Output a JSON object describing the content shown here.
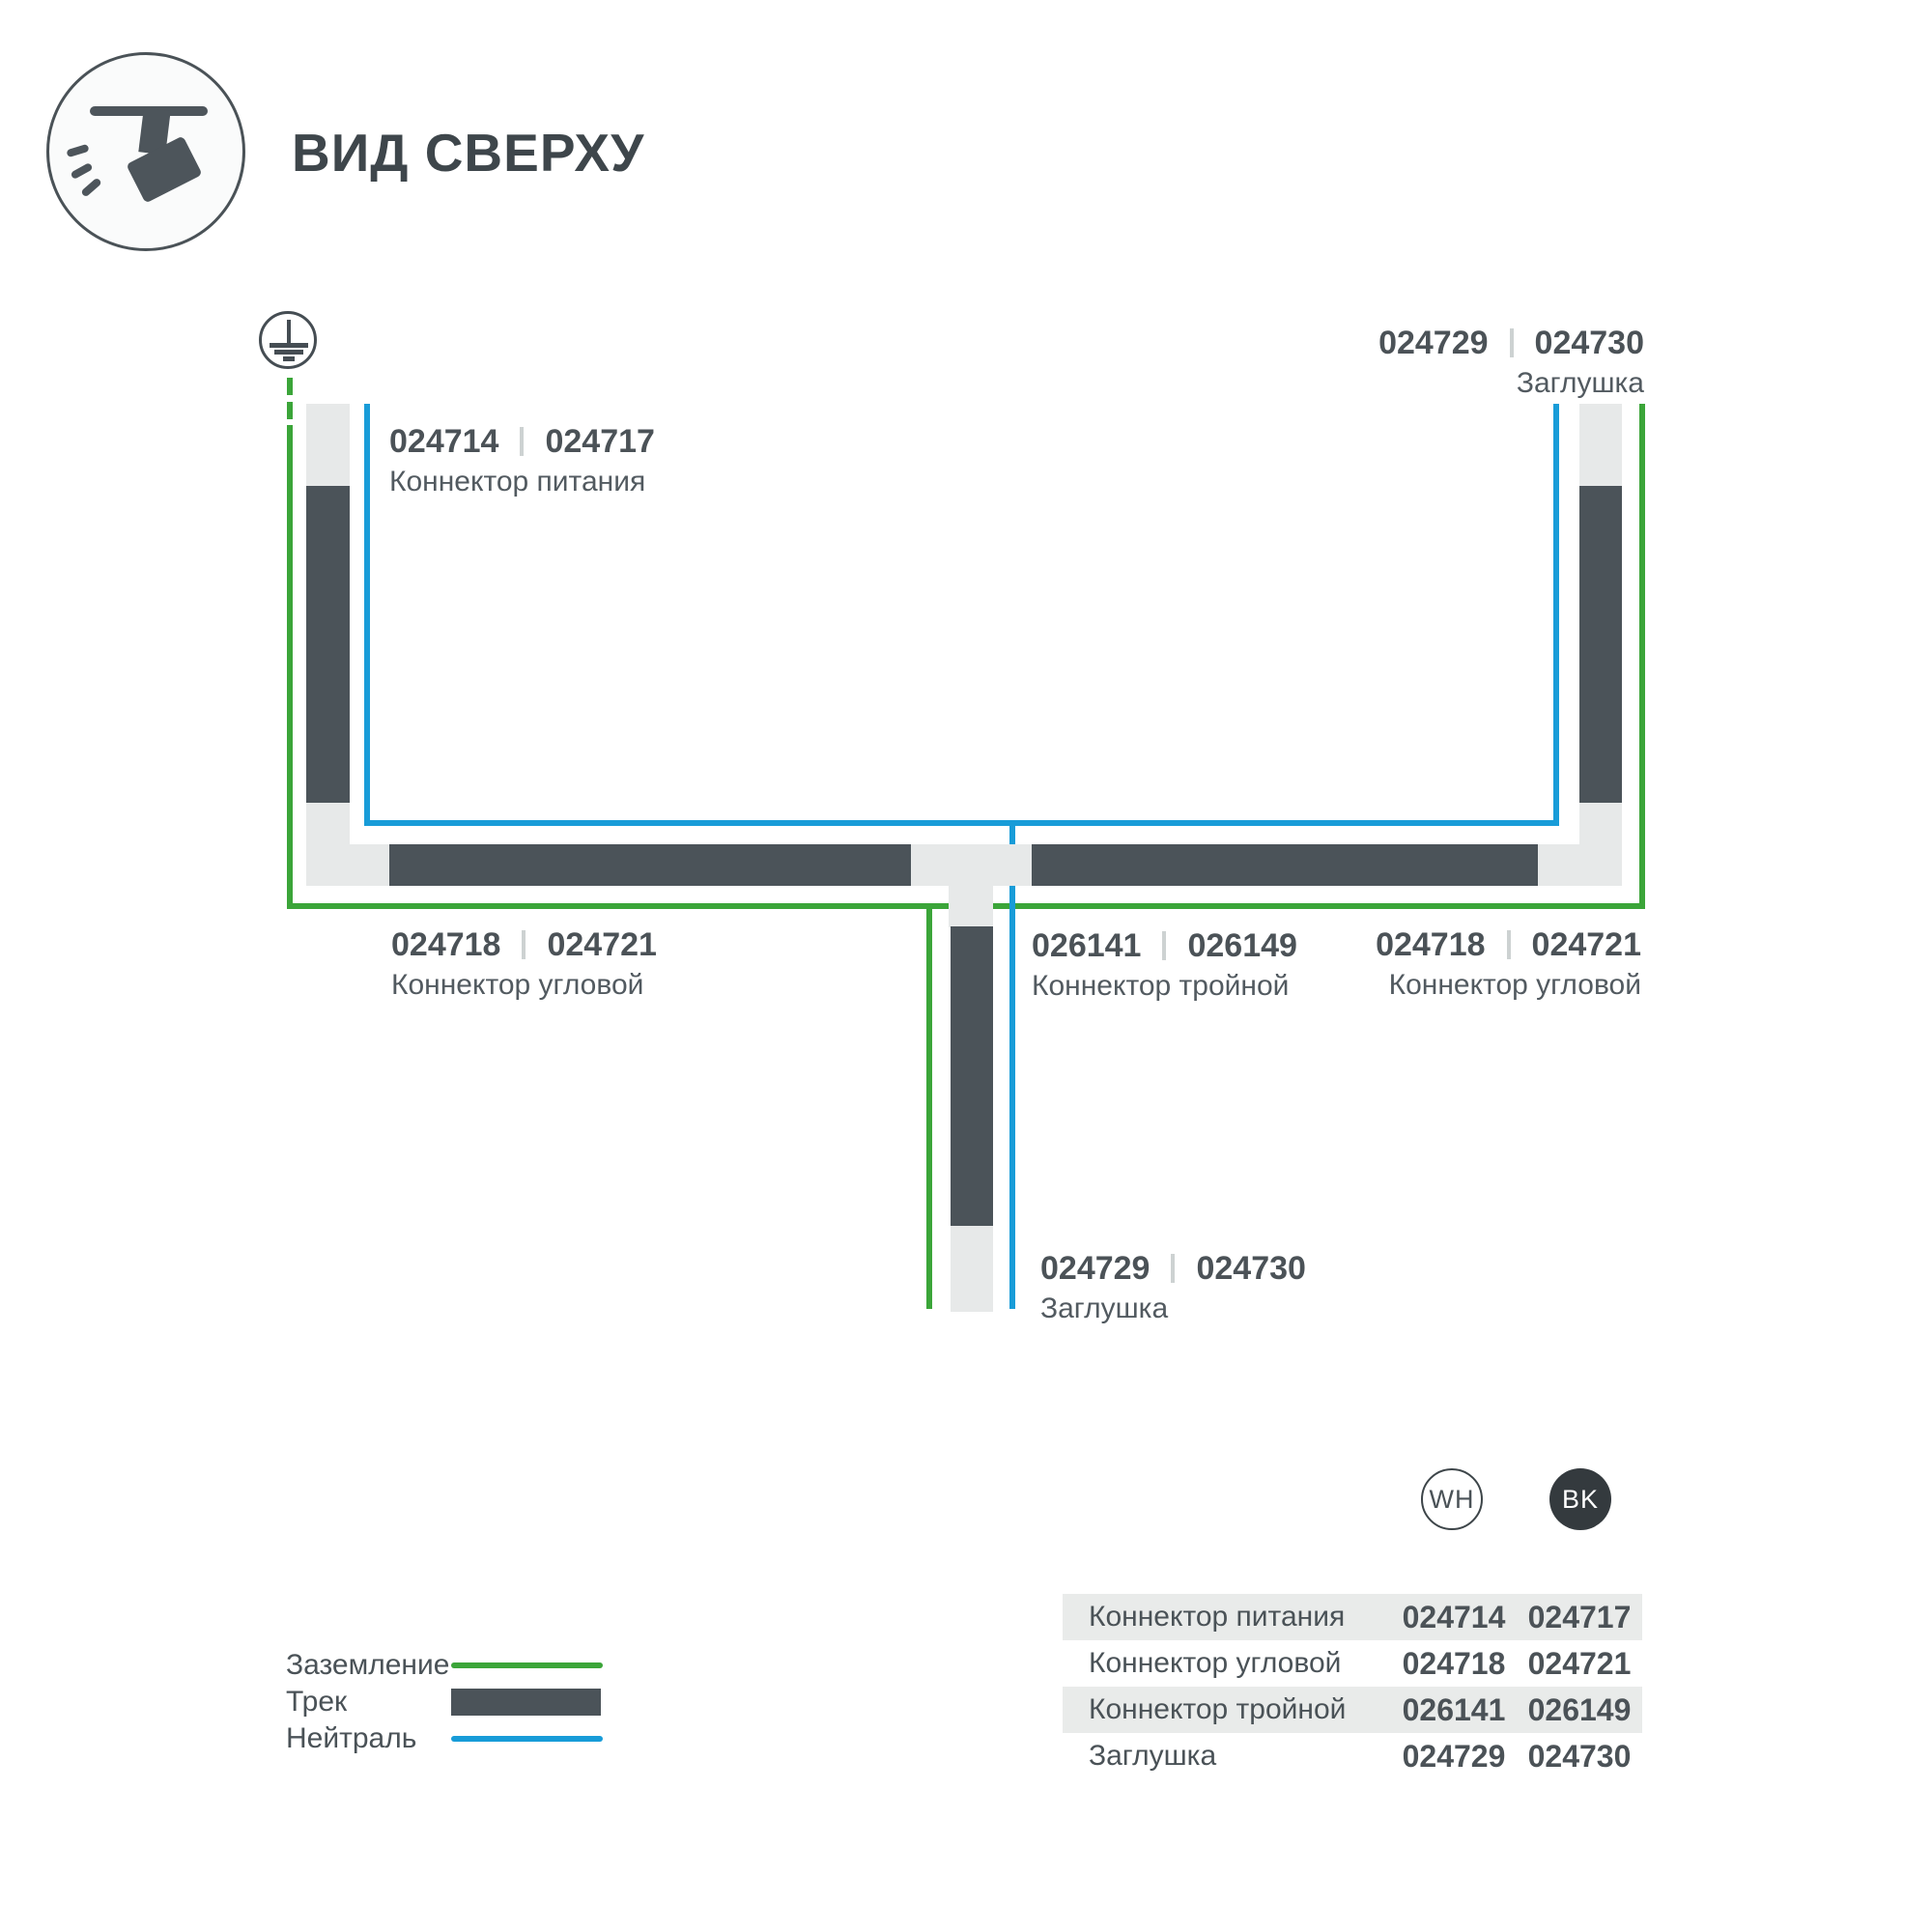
{
  "title": "ВИД СВЕРХУ",
  "diagram": {
    "labels": {
      "power": {
        "code_wh": "024714",
        "code_bk": "024717",
        "name": "Коннектор питания"
      },
      "endcap_top": {
        "code_wh": "024729",
        "code_bk": "024730",
        "name": "Заглушка"
      },
      "corner_left": {
        "code_wh": "024718",
        "code_bk": "024721",
        "name": "Коннектор угловой"
      },
      "tee": {
        "code_wh": "026141",
        "code_bk": "026149",
        "name": "Коннектор тройной"
      },
      "corner_right": {
        "code_wh": "024718",
        "code_bk": "024721",
        "name": "Коннектор угловой"
      },
      "endcap_bottom": {
        "code_wh": "024729",
        "code_bk": "024730",
        "name": "Заглушка"
      }
    }
  },
  "legend": {
    "items": [
      {
        "label": "Заземление",
        "swatch": "green-line"
      },
      {
        "label": "Трек",
        "swatch": "track-bar"
      },
      {
        "label": "Нейтраль",
        "swatch": "blue-line"
      }
    ]
  },
  "badges": {
    "wh": "WH",
    "bk": "BK"
  },
  "table": {
    "rows": [
      {
        "name": "Коннектор питания",
        "code_wh": "024714",
        "code_bk": "024717"
      },
      {
        "name": "Коннектор угловой",
        "code_wh": "024718",
        "code_bk": "024721"
      },
      {
        "name": "Коннектор тройной",
        "code_wh": "026141",
        "code_bk": "026149"
      },
      {
        "name": "Заглушка",
        "code_wh": "024729",
        "code_bk": "024730"
      }
    ]
  },
  "colors": {
    "ground_green": "#3ba539",
    "neutral_blue": "#189cd8",
    "track_dark": "#4b5359",
    "track_light": "#e7e9e9",
    "text_dark": "#4a5257",
    "table_row_bg": "#e9ebea",
    "badge_bk_bg": "#343a3e"
  }
}
